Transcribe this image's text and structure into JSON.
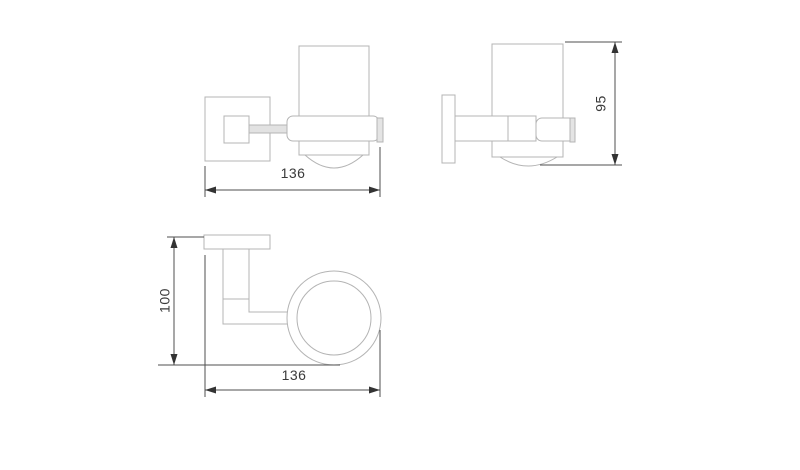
{
  "drawing": {
    "kind": "orthographic technical drawing, wall-mounted tumbler holder",
    "dimensions": {
      "front_width": "136",
      "side_height": "95",
      "top_depth": "100",
      "top_width": "136"
    },
    "colors": {
      "background": "#ffffff",
      "object_line": "#b4b4b4",
      "dimension_line": "#4f4f4f",
      "arrow": "#333333",
      "label_text": "#3a3a3a",
      "rod_fill": "#e2e2e2",
      "cap_fill": "#e4e4e4"
    }
  }
}
